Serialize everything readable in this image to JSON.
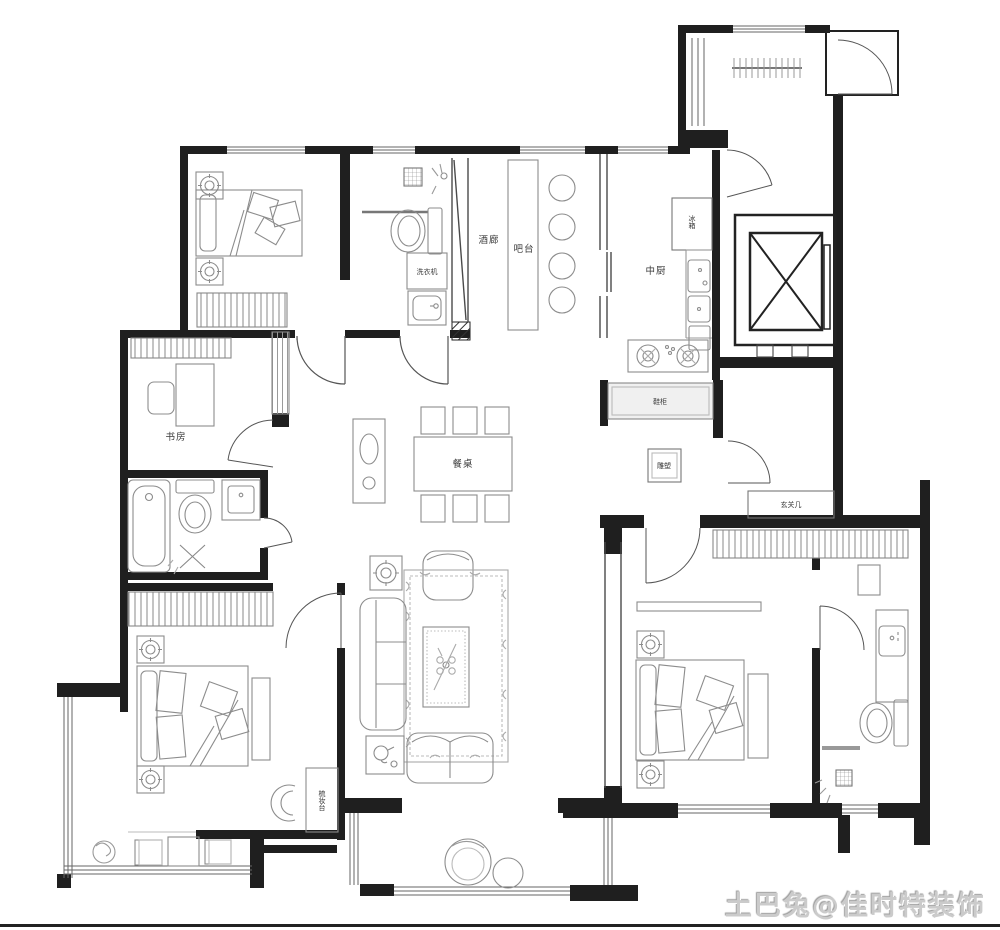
{
  "page": {
    "background": "#ffffff",
    "wall_color": "#1f1f1f",
    "furniture_line_color": "#8c8c8c",
    "label_color": "#3a3a3a"
  },
  "watermark": {
    "text": "土巴兔@佳时特装饰",
    "color": "#cbcbcb"
  },
  "floor_plan": {
    "labels": {
      "wine_lounge": "酒廊",
      "bar_counter": "吧台",
      "kitchen": "中厨",
      "fridge": "冰箱",
      "washing_machine": "洗衣机",
      "study": "书房",
      "shoe_cabinet": "鞋柜",
      "sculpture": "雕塑",
      "entry_console": "玄关几",
      "dining_table": "餐桌",
      "dressing_table": "梳妆台"
    }
  }
}
